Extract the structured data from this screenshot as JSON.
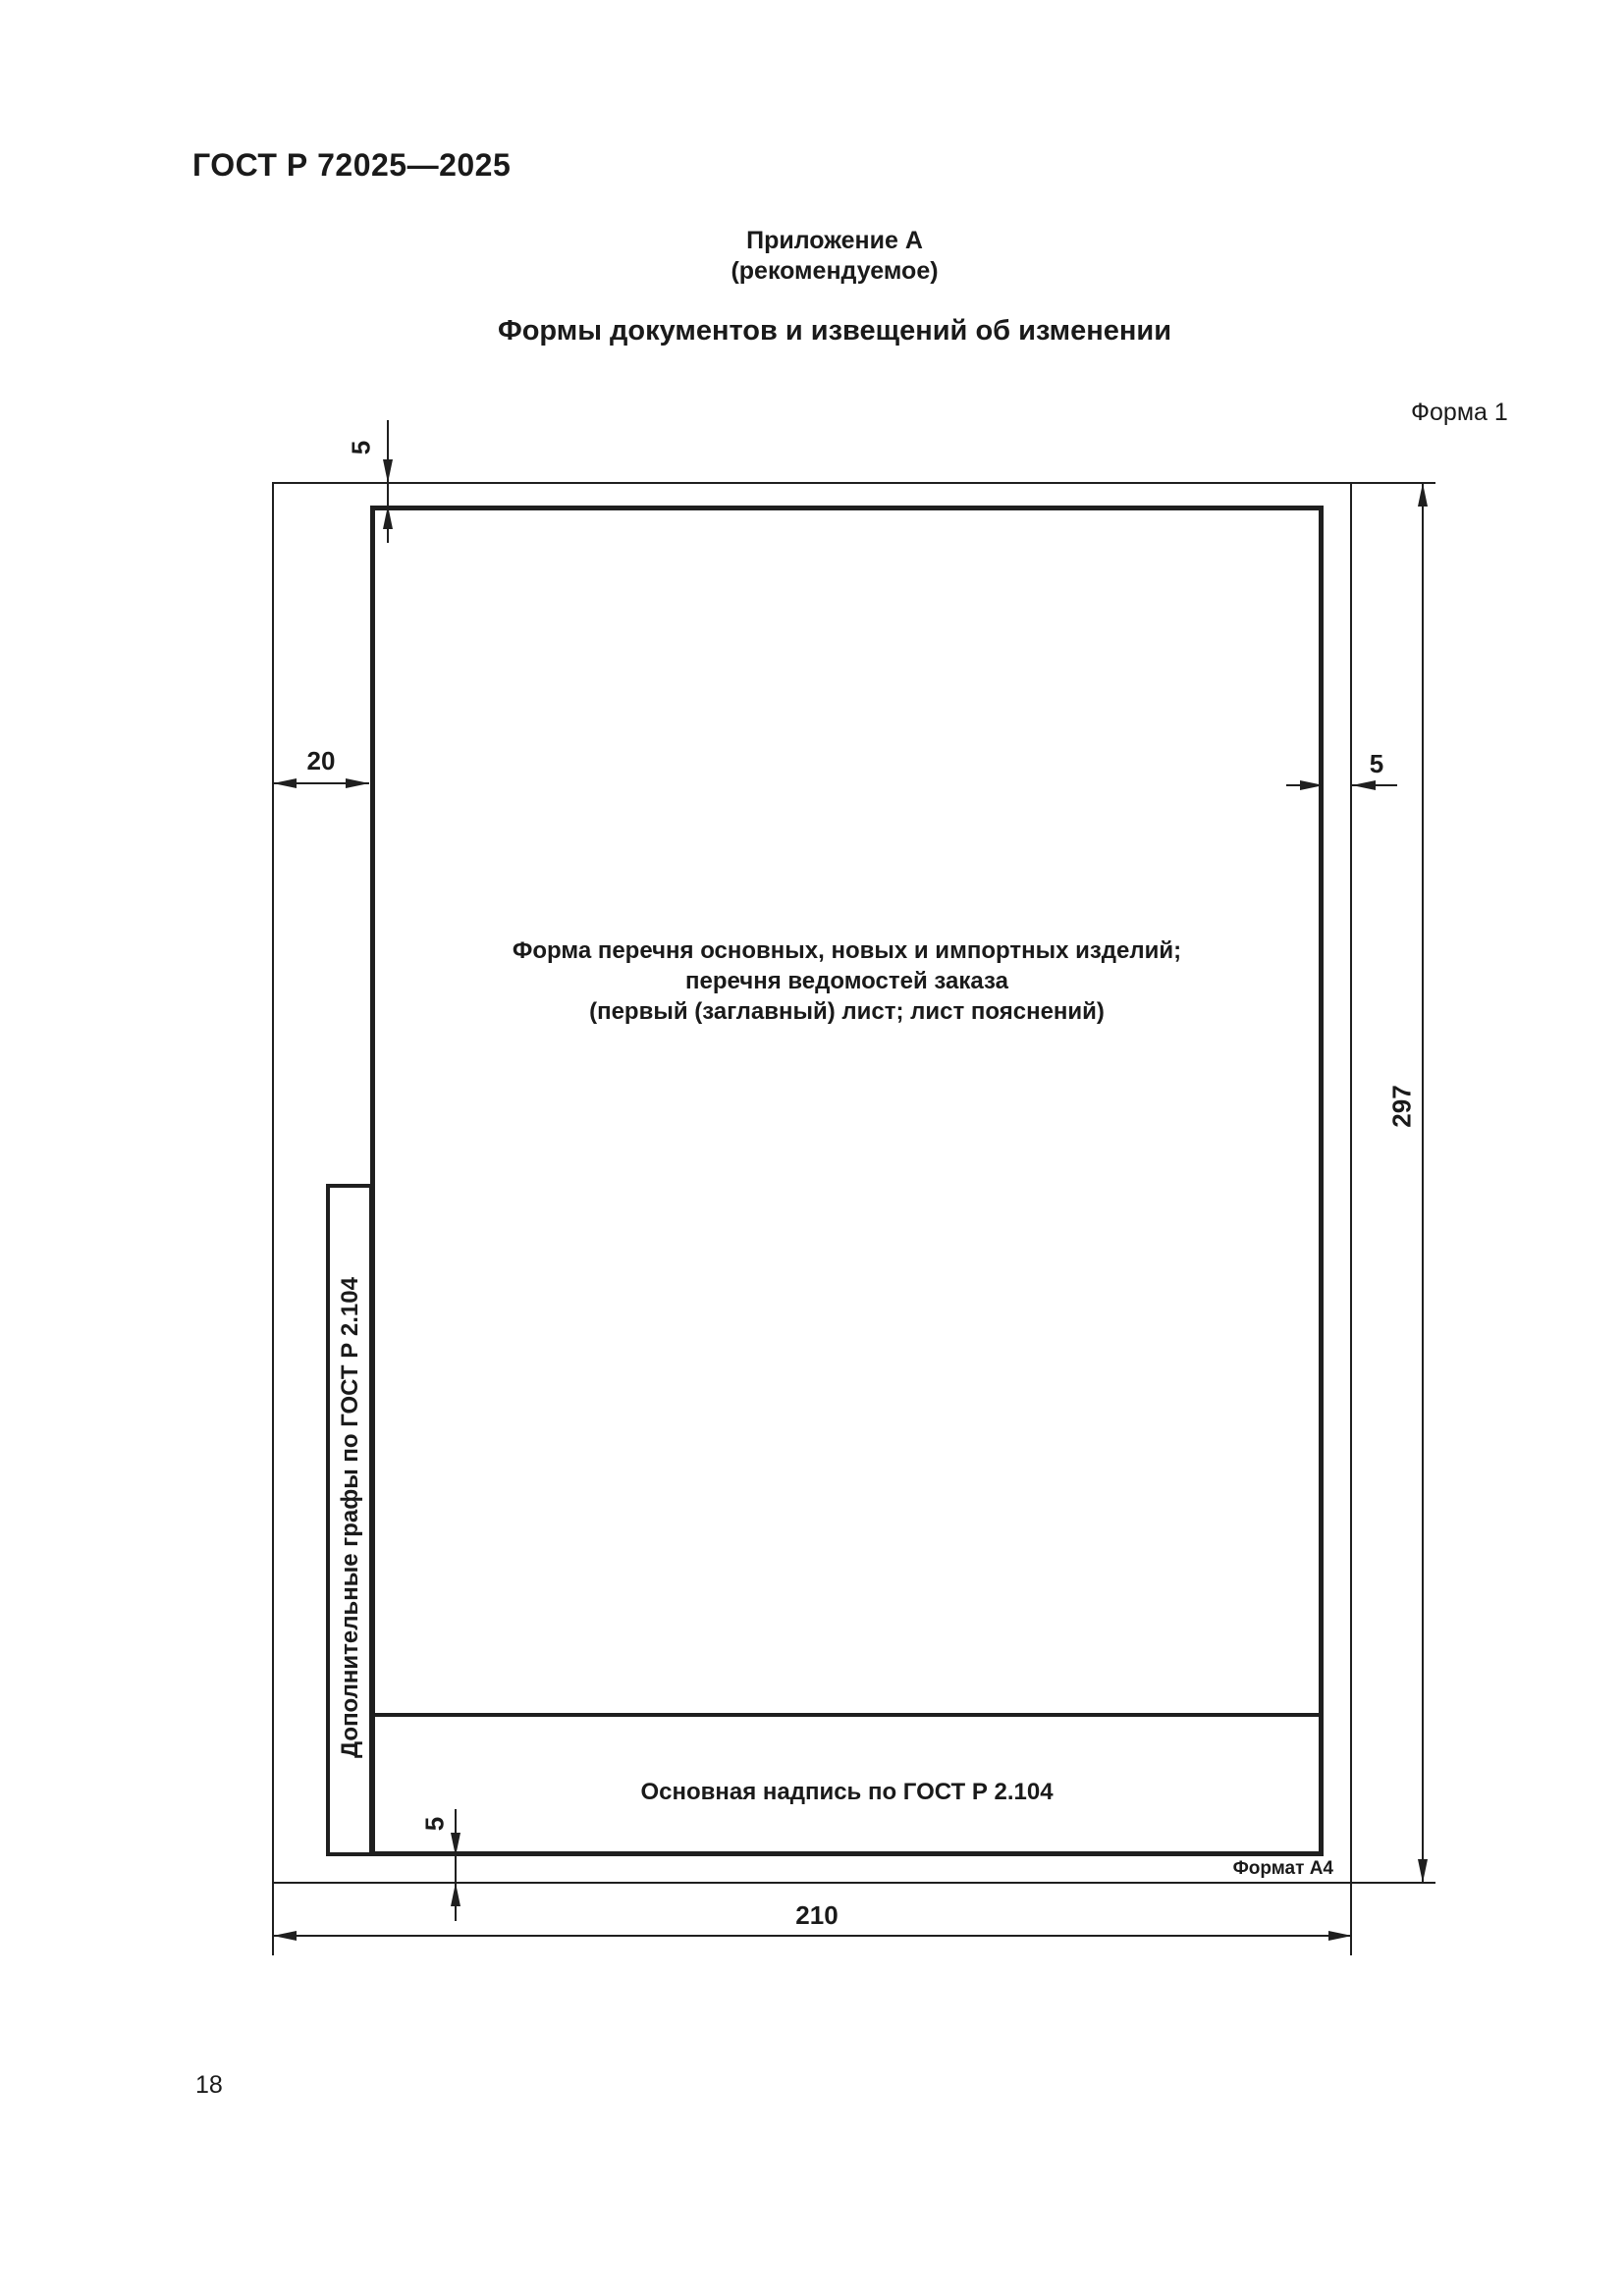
{
  "document": {
    "standard_number": "ГОСТ Р 72025—2025",
    "page_number": "18"
  },
  "appendix": {
    "title": "Приложение А",
    "type_note": "(рекомендуемое)",
    "heading": "Формы документов и извещений об изменении",
    "form_caption": "Форма 1"
  },
  "figure": {
    "sheet_description": {
      "line1": "Форма перечня основных, новых и импортных изделий;",
      "line2": "перечня ведомостей заказа",
      "line3": "(первый (заглавный) лист; лист пояснений)"
    },
    "side_column_label": "Дополнительные графы по ГОСТ Р 2.104",
    "title_block_label": "Основная надпись по ГОСТ Р 2.104",
    "format_label": "Формат А4",
    "dimensions": {
      "top_margin_mm": "5",
      "left_margin_mm": "20",
      "right_margin_mm": "5",
      "bottom_margin_mm": "5",
      "sheet_height_mm": "297",
      "sheet_width_mm": "210"
    },
    "ink_color": "#1f1f1f"
  }
}
